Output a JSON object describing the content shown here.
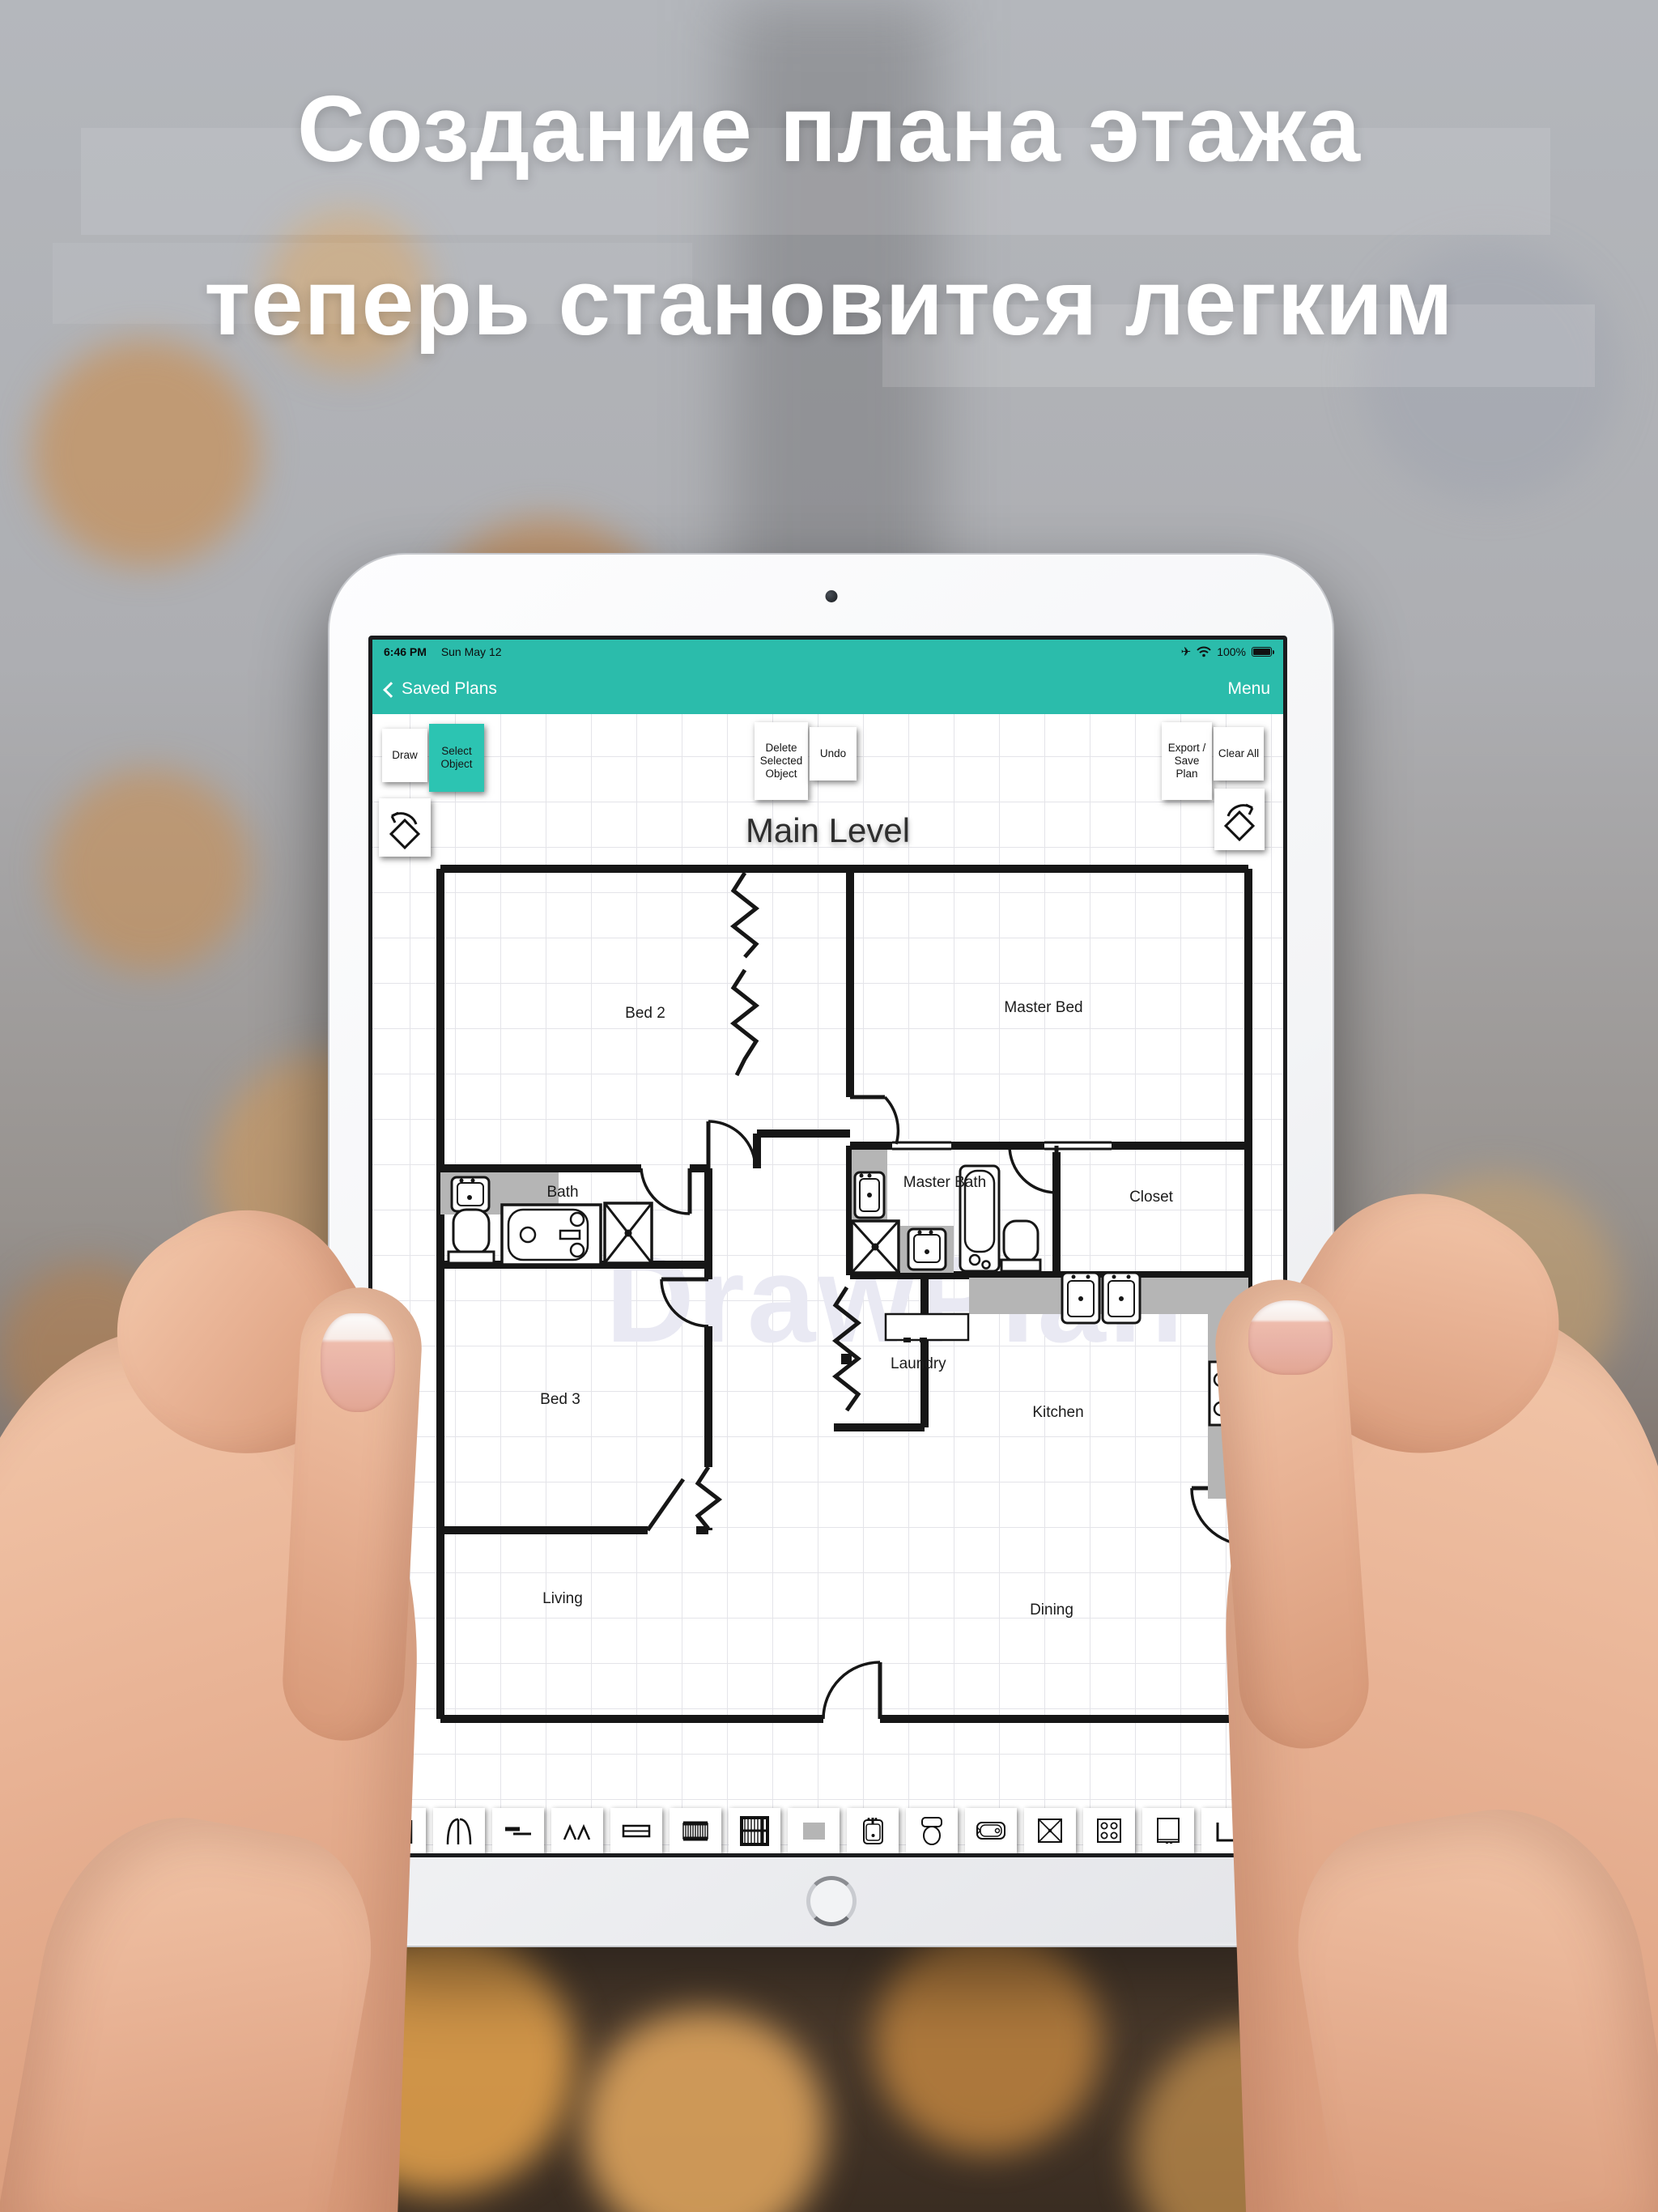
{
  "promo": {
    "line1": "Создание плана этажа",
    "line2": "теперь становится легким"
  },
  "status": {
    "time": "6:46 PM",
    "date": "Sun May 12",
    "battery": "100%"
  },
  "nav": {
    "back_label": "Saved Plans",
    "menu_label": "Menu"
  },
  "tools": {
    "draw": "Draw",
    "select_object": "Select Object",
    "delete_selected": "Delete Selected Object",
    "undo": "Undo",
    "export_save": "Export / Save Plan",
    "clear_all": "Clear All"
  },
  "plan": {
    "level_title": "Main Level",
    "watermark": "DrawPlan",
    "rooms": [
      {
        "name": "Bed 2"
      },
      {
        "name": "Master Bed"
      },
      {
        "name": "Bath"
      },
      {
        "name": "Master Bath"
      },
      {
        "name": "Closet"
      },
      {
        "name": "Bed 3"
      },
      {
        "name": "Laundry"
      },
      {
        "name": "Kitchen"
      },
      {
        "name": "Living"
      },
      {
        "name": "Dining"
      }
    ]
  },
  "palette_icons": [
    "single-door",
    "double-door",
    "pocket-door",
    "bay-window",
    "window",
    "stairs",
    "staircase",
    "countertop",
    "sink",
    "toilet",
    "bathtub",
    "shower",
    "stove",
    "refrigerator",
    "washer"
  ],
  "colors": {
    "teal": "#2bbcab",
    "teal_selected": "#2cc4b2",
    "wall": "#161616",
    "counter_gray": "#b5b5b5",
    "grid": "#e4e4e9",
    "watermark": "#e9e9f3"
  }
}
